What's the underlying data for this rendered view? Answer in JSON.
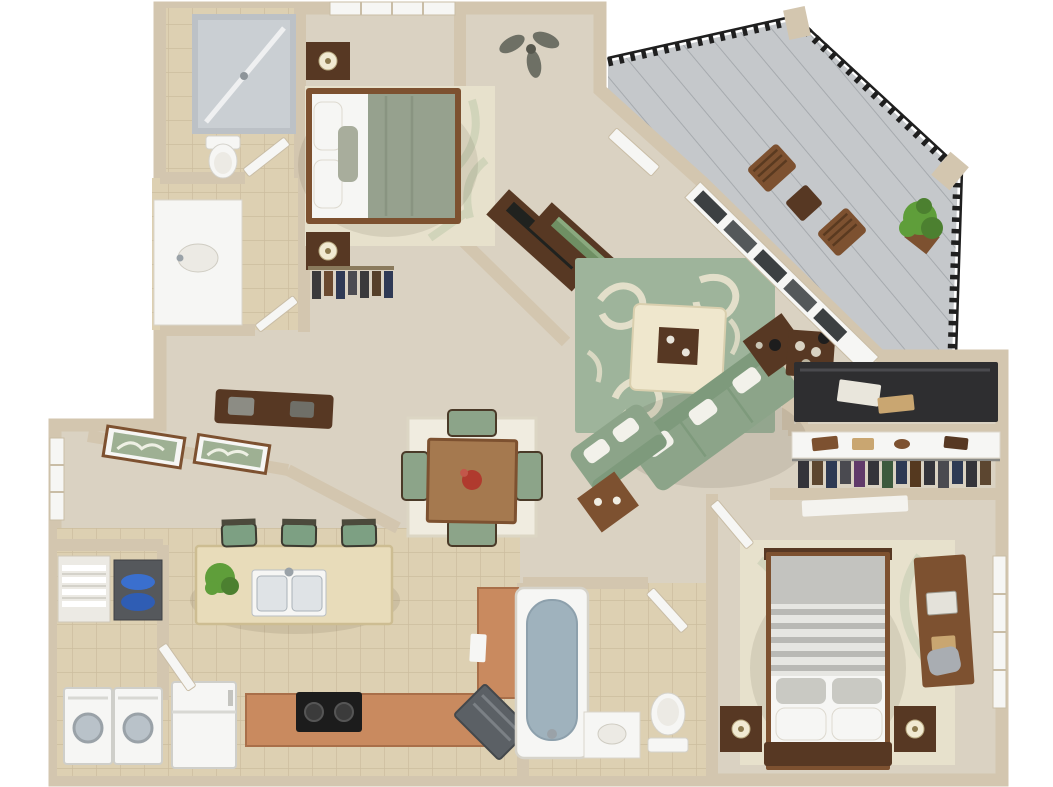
{
  "scene": {
    "type": "3d-apartment-floor-plan",
    "style": "top-down 3D rendered floor plan, two bedrooms, no text labels visible",
    "palette": {
      "wall": "#d3c6af",
      "wallShadow": "#b7a98f",
      "carpet": "#dad2c2",
      "tile": "#ddd0b2",
      "tileLine": "#ccbd9e",
      "balconyFloor": "#c5c8cb",
      "balconyPlank": "#a6aaae",
      "railing": "#1f1f1f",
      "white": "#f6f6f4",
      "offWhite": "#eceae4",
      "glass": "#bcc1c6",
      "steel": "#9aa2a8",
      "woodDark": "#573823",
      "woodMed": "#7d5130",
      "woodLight": "#c9a671",
      "terracotta": "#c98a5f",
      "sofaGreen": "#8ca489",
      "rugGreen": "#9eb49b",
      "rugCream": "#e7e1cc",
      "bedGreen": "#96a18e",
      "water": "#9fb2bd",
      "plant": "#5f9e3a",
      "stove": "#1c1c1c"
    },
    "rooms": [
      {
        "name": "Master Bathroom",
        "features": [
          "glass shower",
          "toilet",
          "white vanity with oval sink"
        ]
      },
      {
        "name": "Master Bedroom",
        "features": [
          "bed with sage duvet and white pillows",
          "two dark nightstands with lamps",
          "cream area rug",
          "window",
          "ceiling fan",
          "media console on angled wall"
        ]
      },
      {
        "name": "Entry",
        "features": [
          "front door",
          "dark console with green books"
        ]
      },
      {
        "name": "Living Room",
        "features": [
          "sage green sofa",
          "sage loveseat",
          "cream ottoman with wood tray",
          "green swirl-pattern rug",
          "two end tables",
          "bar cabinet",
          "window wall to balcony"
        ]
      },
      {
        "name": "Balcony",
        "features": [
          "black metal railing",
          "gray plank decking",
          "two wood chairs",
          "side table",
          "potted plant at corner"
        ]
      },
      {
        "name": "Office Nook",
        "features": [
          "dark desk with papers"
        ]
      },
      {
        "name": "Walk-in Closet",
        "features": [
          "white shelf with shoes and bags",
          "hanging clothes"
        ]
      },
      {
        "name": "Dressing Hall",
        "features": [
          "clothes rack with hangers",
          "dark wood bench",
          "two framed botanical prints",
          "window"
        ]
      },
      {
        "name": "Dining Area",
        "features": [
          "square wood table with red centerpiece",
          "four green-cushion chairs",
          "cream rug"
        ]
      },
      {
        "name": "Kitchen",
        "features": [
          "island with double sink",
          "three green bar stools",
          "black cooktop",
          "white refrigerator",
          "angled dishwasher",
          "terracotta counters",
          "green plant"
        ]
      },
      {
        "name": "Laundry",
        "features": [
          "washer",
          "dryer",
          "linen shelves with towels",
          "shelf with blue towels"
        ]
      },
      {
        "name": "Bathroom",
        "features": [
          "bathtub with water",
          "toilet",
          "small vanity"
        ]
      },
      {
        "name": "Bedroom 2",
        "features": [
          "bed with gray striped duvet",
          "two dark nightstands with lamps",
          "wood desk with chair",
          "cream leaf rug",
          "window"
        ]
      }
    ]
  }
}
